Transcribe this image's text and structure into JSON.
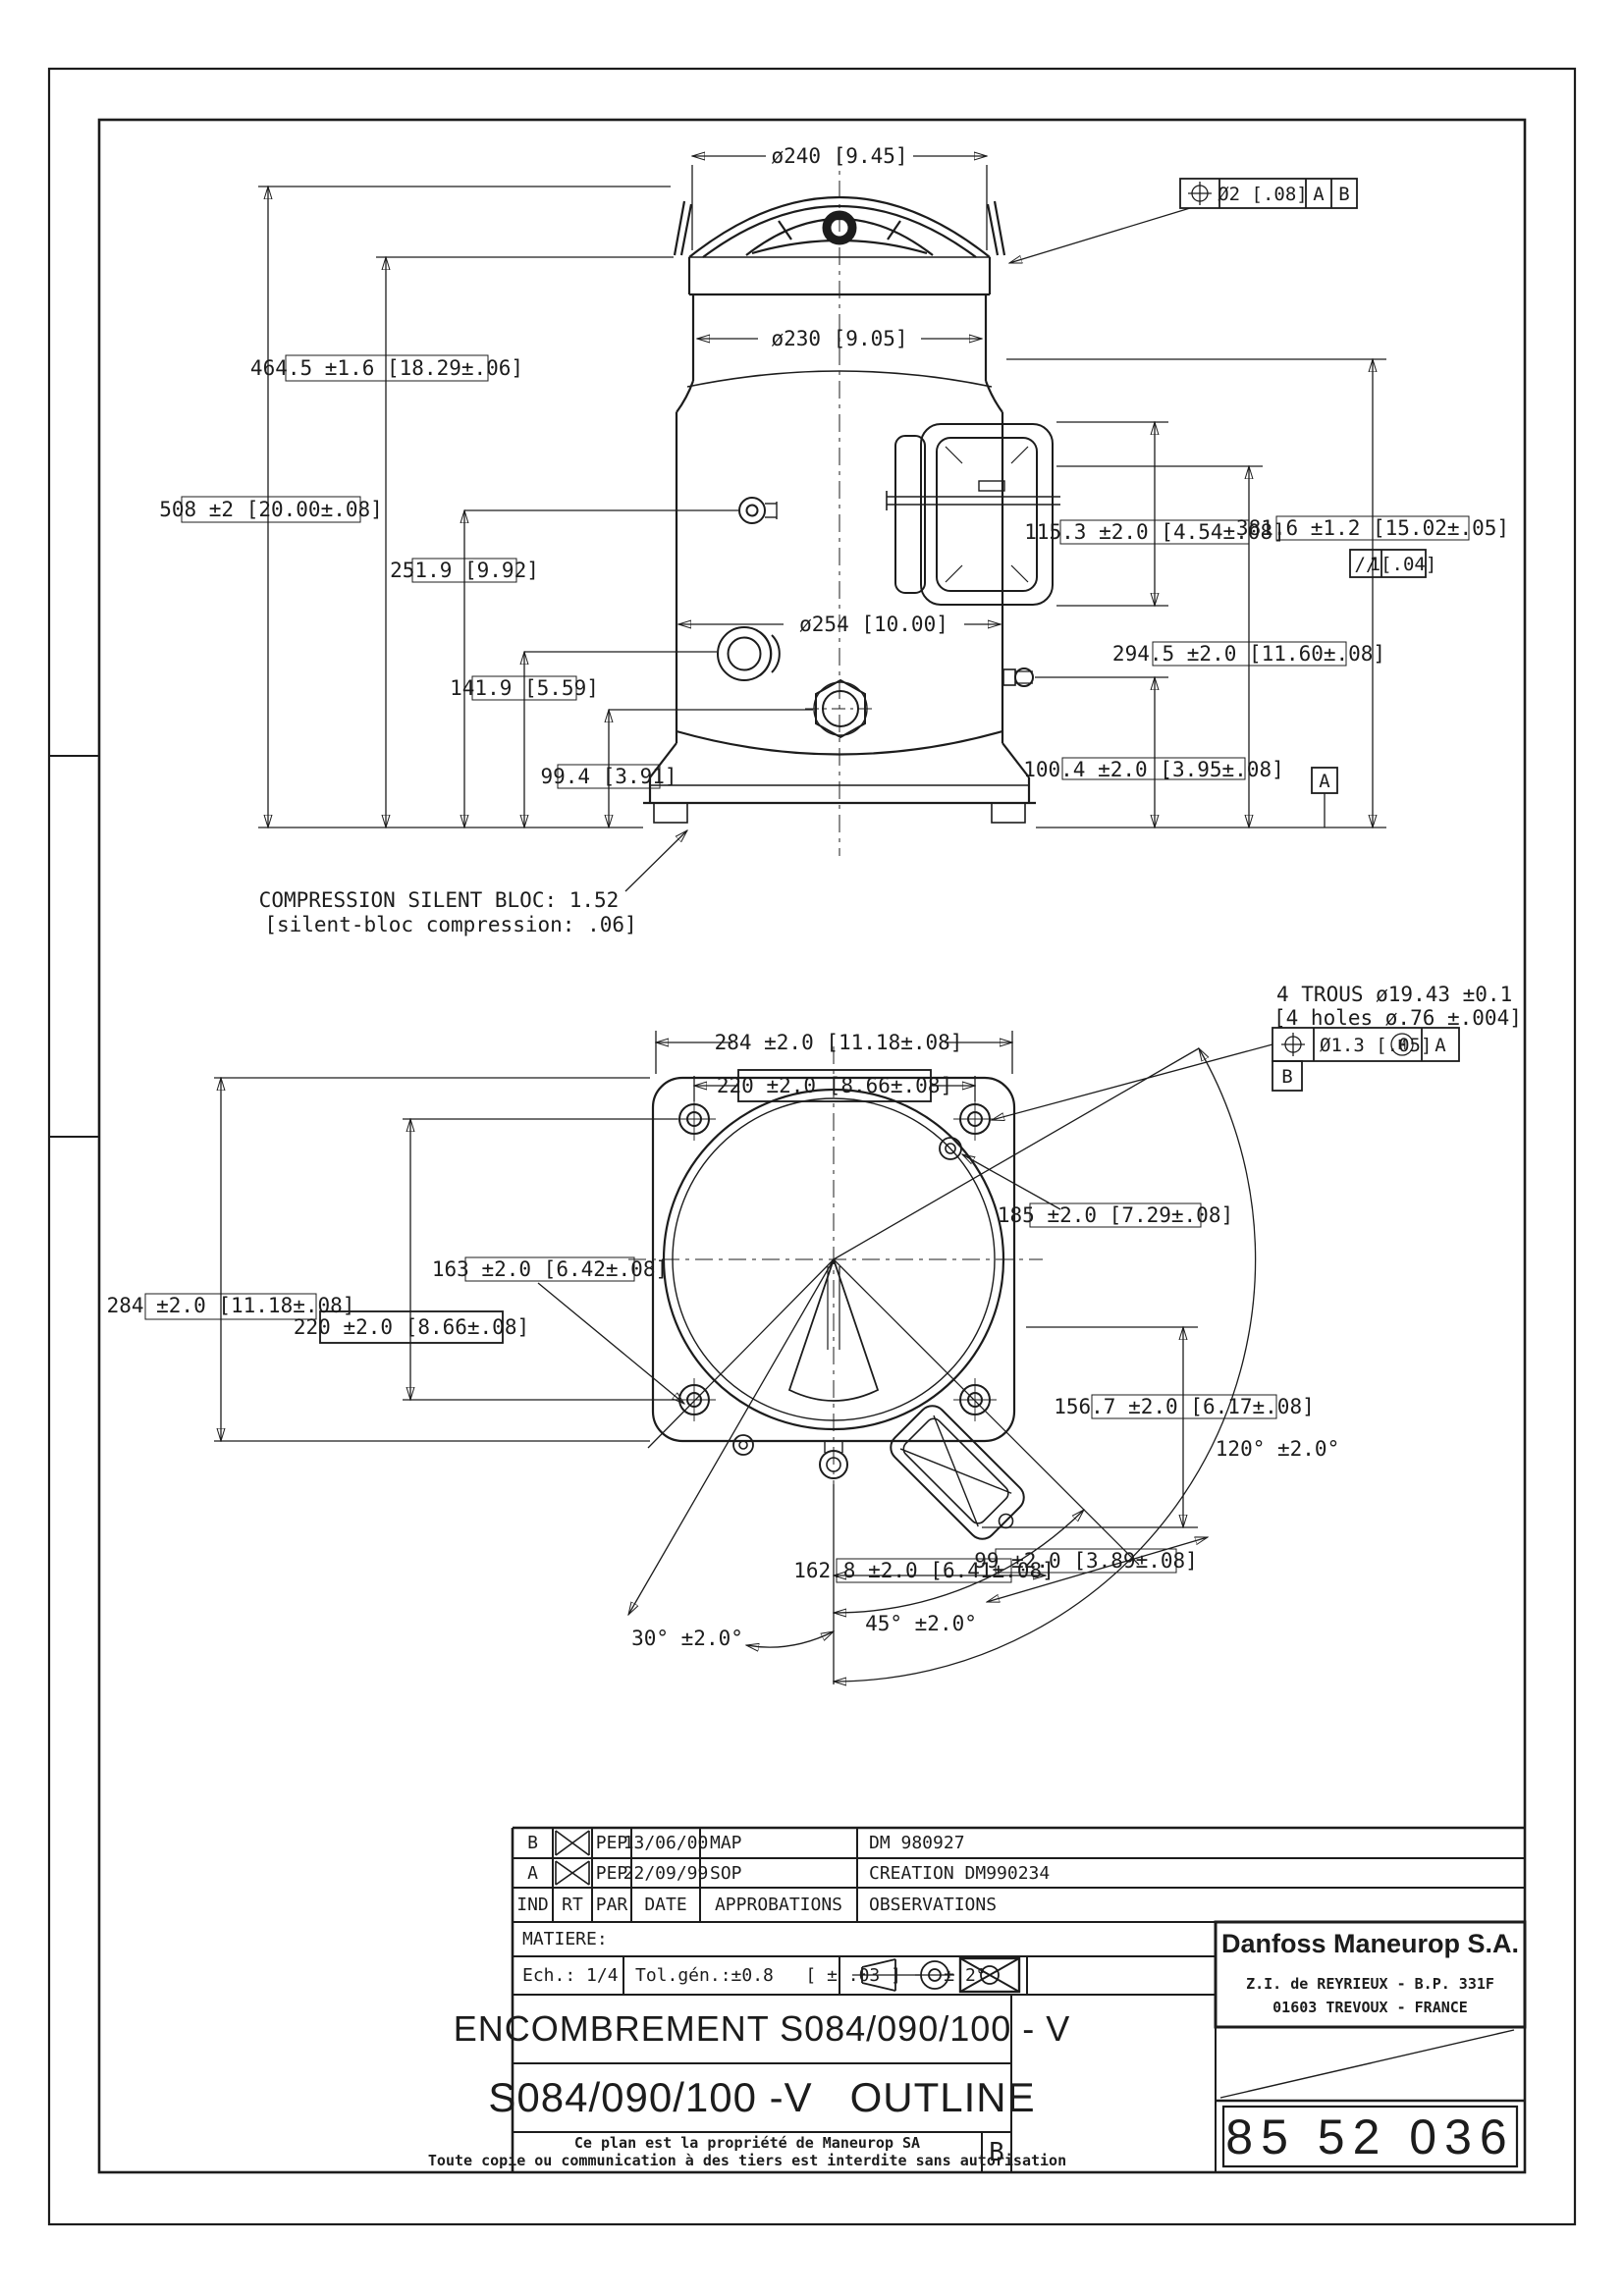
{
  "top_view": {
    "dims": {
      "dia240": "ø240 [9.45]",
      "dia230": "ø230 [9.05]",
      "dia254": "ø254 [10.00]",
      "h508": "508 ±2 [20.00±.08]",
      "h464": "464.5 ±1.6 [18.29±.06]",
      "h251": "251.9 [9.92]",
      "h141": "141.9 [5.59]",
      "h99": "99.4 [3.91]",
      "h115": "115.3 ±2.0 [4.54±.08]",
      "h381": "381.6 ±1.2 [15.02±.05]",
      "h294": "294.5 ±2.0 [11.60±.08]",
      "h100": "100.4 ±2.0 [3.95±.08]"
    },
    "tol_frame": {
      "symbol": "position",
      "value": "Ø2 [.08]",
      "datum1": "A",
      "datum2": "B"
    },
    "parallel_frame": {
      "symbol": "//",
      "value": "1[.04]"
    },
    "datum_a": "A",
    "silent_bloc_line1": "COMPRESSION SILENT BLOC: 1.52",
    "silent_bloc_line2": "[silent-bloc compression:  .06]"
  },
  "bottom_view": {
    "dims": {
      "w284_top": "284 ±2.0 [11.18±.08]",
      "w220_top": "220 ±2.0 [8.66±.08]",
      "h284_left": "284 ±2.0 [11.18±.08]",
      "h220_left": "220 ±2.0 [8.66±.08]",
      "d163": "163 ±2.0 [6.42±.08]",
      "d185": "185 ±2.0 [7.29±.08]",
      "d156": "156.7 ±2.0 [6.17±.08]",
      "a120": "120° ±2.0°",
      "d162": "162.8 ±2.0 [6.41±.08]",
      "d99": "99 ±2.0 [3.89±.08]",
      "a45": "45° ±2.0°",
      "a30": "30° ±2.0°"
    },
    "holes_note_line1": "4 TROUS ø19.43 ±0.1",
    "holes_note_line2": "[4 holes ø.76 ±.004]",
    "holes_frame": {
      "symbol": "position",
      "value": "Ø1.3 [.05]",
      "modifier": "M",
      "datum": "A"
    },
    "datum_b": "B"
  },
  "title_block": {
    "revisions": [
      {
        "ind": "B",
        "par": "PEP",
        "date": "13/06/00",
        "approbation": "MAP",
        "observation": "DM 980927"
      },
      {
        "ind": "A",
        "par": "PEP",
        "date": "22/09/99",
        "approbation": "SOP",
        "observation": "CREATION DM990234"
      }
    ],
    "headers": {
      "ind": "IND",
      "rt": "RT",
      "par": "PAR",
      "date": "DATE",
      "approbations": "APPROBATIONS",
      "observations": "OBSERVATIONS"
    },
    "matiere_label": "MATIERE:",
    "scale_label": "Ech.: 1/4",
    "tolerance_label": "Tol.gén.:±0.8   [ ± .03 ]    ± 2°",
    "title_fr": "ENCOMBREMENT S084/090/100 - V",
    "title_en": "S084/090/100 -V   OUTLINE",
    "company": {
      "name": "Danfoss Maneurop S.A.",
      "address1": "Z.I. de REYRIEUX - B.P. 331F",
      "address2": "01603 TREVOUX - FRANCE"
    },
    "drawing_number": "85 52 036",
    "revision_letter": "B",
    "note_line1": "Ce plan est la propriété de Maneurop SA",
    "note_line2": "Toute copie ou communication à des tiers est interdite sans autorisation"
  }
}
